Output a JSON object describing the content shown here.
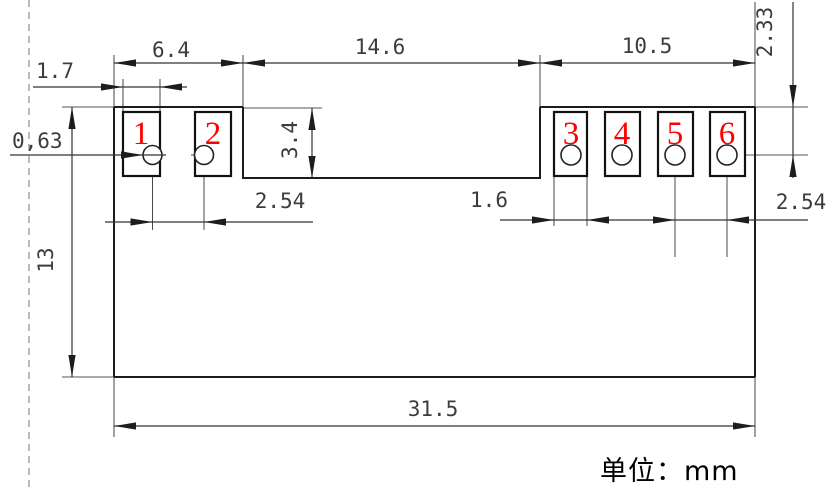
{
  "note": "单位：mm",
  "pins": [
    "1",
    "2",
    "3",
    "4",
    "5",
    "6"
  ],
  "dims": {
    "left_section_width": "6.4",
    "middle_section_width": "14.6",
    "right_section_width": "10.5",
    "left_pad_width": "1.7",
    "hole_offset": "0,63",
    "body_height": "13",
    "notch_depth": "3.4",
    "hole_to_top_edge": "2.33",
    "left_hole_pitch": "2.54",
    "right_pad_width": "1.6",
    "right_hole_pitch": "2.54",
    "body_width": "31.5"
  },
  "colors": {
    "pin_number": "#ff0000",
    "outline": "#1c1c1c",
    "dimension": "#3c3c3c",
    "dashed_guide": "#a3a3a3"
  }
}
